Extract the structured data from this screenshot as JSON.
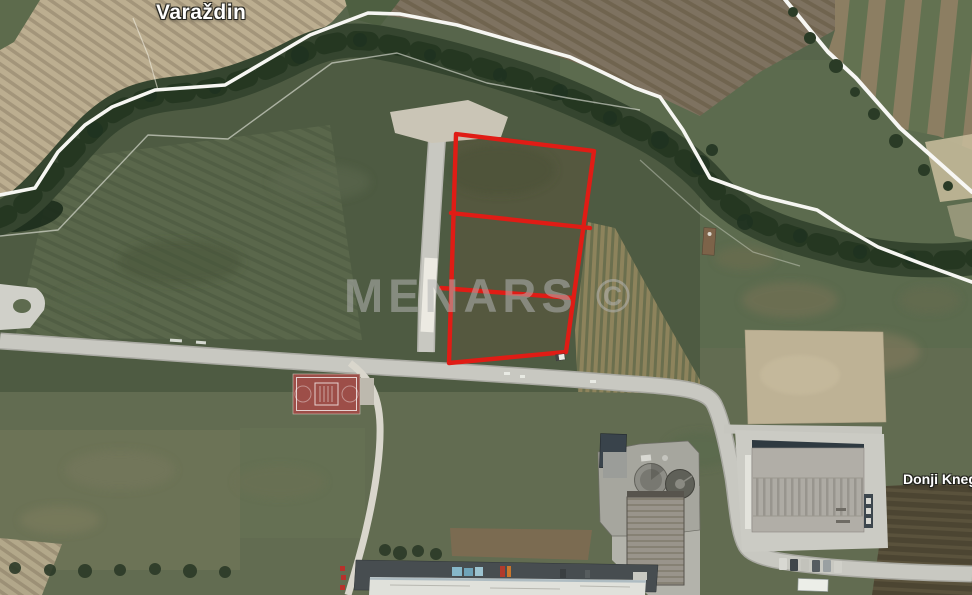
{
  "map": {
    "labels": {
      "city": "Varaždin",
      "village": "Donji Kneg",
      "watermark": "MENARS ©"
    },
    "parcel": {
      "subdivisions": 3,
      "outline_color": "#e01c15"
    },
    "colors": {
      "boundary_line": "#f6f6f2",
      "road": "#c8c8c1",
      "plowed_field": "#bcae90",
      "grass_field": "#55634a",
      "river_corridor": "#2c3c28",
      "sports_court": "#9d4e48",
      "warehouse_roof": "#b1aea7"
    }
  }
}
